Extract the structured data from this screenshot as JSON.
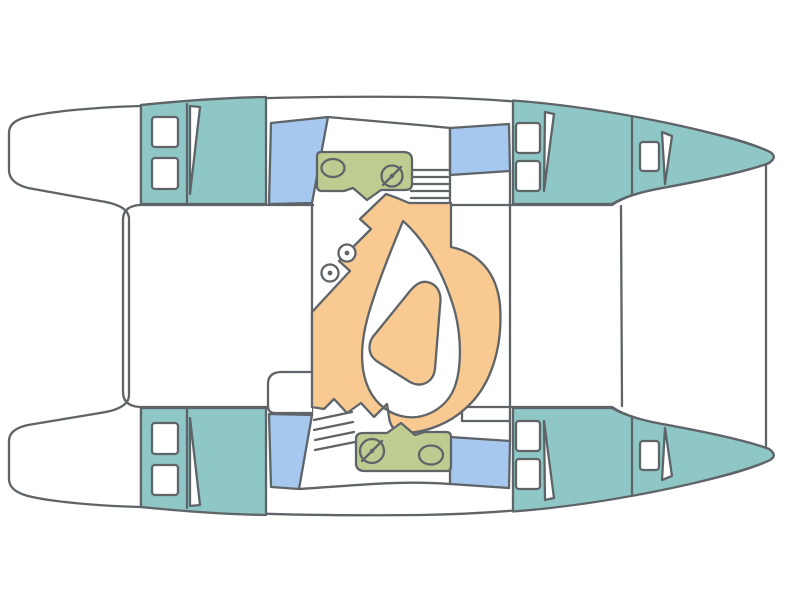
{
  "diagram": {
    "type": "boat-floor-plan",
    "subject": "catamaran-deck-layout-top-view",
    "orientation": "bows pointing right, transom steps at left",
    "text_labels": [],
    "features": {
      "hulls": 2,
      "cabin_areas_teal": 4,
      "bow_sections_teal": 2,
      "deck_hatches_white": 10,
      "roof_windows_blue": 4,
      "galley_counters_olive": 2,
      "sink_ovals": 2,
      "stove_burners": 2,
      "dinette_seating_orange": 1,
      "saloon_table_orange": 1,
      "companionway_stairs": 2,
      "door_swings": 6,
      "stools": 2,
      "cockpit_module": 1,
      "foredeck_beam_lines": 2,
      "transom_step_wings": 2
    }
  },
  "colors": {
    "background": "#ffffff",
    "outline": "#5e6468",
    "hull_fill": "#ffffff",
    "cabin_teal": "#8fc7c7",
    "window_blue": "#a6c8ee",
    "galley_olive": "#becc92",
    "seating_orange": "#f8c990",
    "fixture_white": "#ffffff"
  }
}
